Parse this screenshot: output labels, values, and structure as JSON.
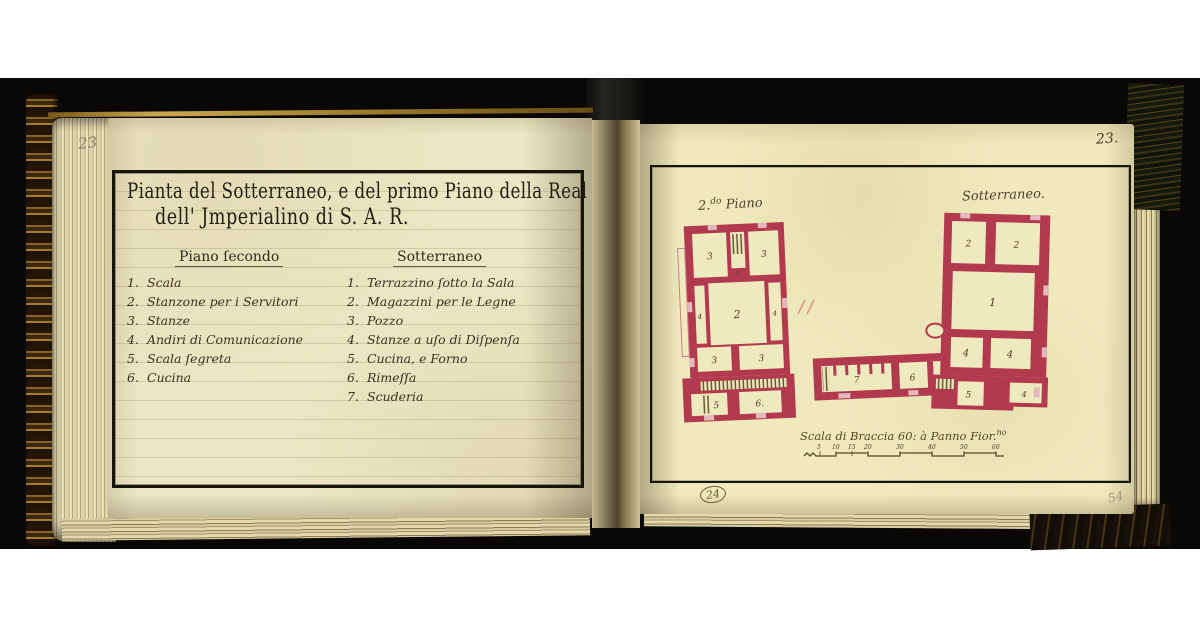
{
  "book": {
    "left_page": {
      "folio_pencil": "23",
      "title": {
        "line1": "Pianta del Sotterraneo, e del primo Piano della Real Villa",
        "line2": "dell' Jmperialino di S. A. R."
      },
      "columns": [
        {
          "header": "Piano ſecondo",
          "items": [
            {
              "num": "1.",
              "label": "Scala"
            },
            {
              "num": "2.",
              "label": "Stanzone per i Servitori"
            },
            {
              "num": "3.",
              "label": "Stanze"
            },
            {
              "num": "4.",
              "label": "Andiri di Comunicazione"
            },
            {
              "num": "5.",
              "label": "Scala ſegreta"
            },
            {
              "num": "6.",
              "label": "Cucina"
            }
          ]
        },
        {
          "header": "Sotterraneo",
          "items": [
            {
              "num": "1.",
              "label": "Terrazzino ſotto la Sala"
            },
            {
              "num": "2.",
              "label": "Magazzini per le Legne"
            },
            {
              "num": "3.",
              "label": "Pozzo"
            },
            {
              "num": "4.",
              "label": "Stanze a uſo di Diſpenſa"
            },
            {
              "num": "5.",
              "label": "Cucina, e Forno"
            },
            {
              "num": "6.",
              "label": "Rimeſſa"
            },
            {
              "num": "7.",
              "label": "Scuderia"
            }
          ]
        }
      ]
    },
    "right_page": {
      "folio_ink": "23.",
      "folio_circled": "24",
      "folio_pencil": "54",
      "plans": [
        {
          "label_prefix": "2.",
          "label_sup": "do",
          "label_rest": " Piano",
          "rooms": [
            "3",
            "1",
            "3",
            "4",
            "2",
            "4",
            "3",
            "3",
            "5",
            "6."
          ]
        },
        {
          "label": "Sotterraneo.",
          "rooms": [
            "2",
            "2",
            "1",
            "4",
            "4",
            "3",
            "5",
            "4",
            "7",
            "6"
          ]
        }
      ],
      "scale": {
        "label_main": "Scala di Braccia 60: à Panno Fior.",
        "label_sup": "no",
        "ticks": [
          "5",
          "10",
          "15",
          "20",
          "30",
          "40",
          "50",
          "60"
        ]
      }
    },
    "colors": {
      "paper_left": "#ebe6c3",
      "paper_right": "#efe9bd",
      "ink": "#241e12",
      "plan_red": "#b23a4e",
      "gold": "#b08d3f"
    }
  }
}
